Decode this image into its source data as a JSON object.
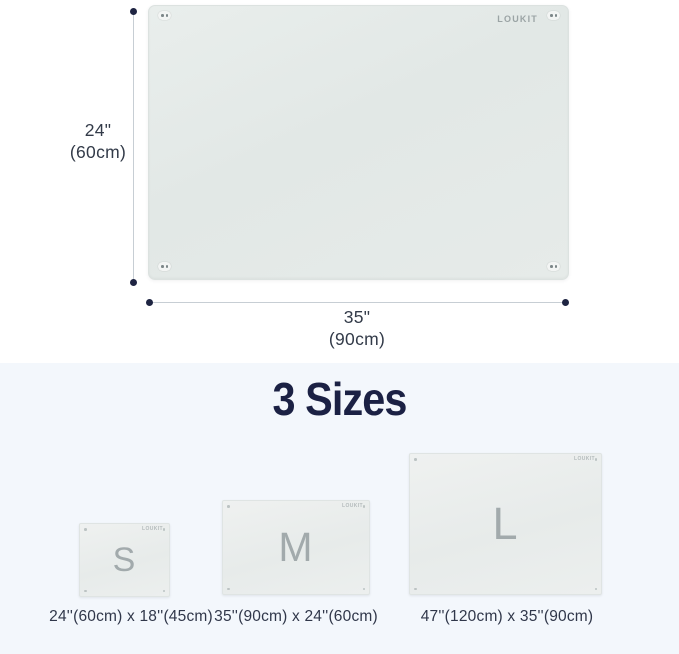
{
  "brand": "LOUKIT",
  "colors": {
    "accent_navy": "#1e2442",
    "title_navy": "#1b2144",
    "board_surface": "#e5eae8",
    "dimension_line": "#c7ced4",
    "section_background": "#f3f7fc",
    "letter_gray": "#a2aaac"
  },
  "hero": {
    "height_label": {
      "line1": "24\"",
      "line2": "(60cm)"
    },
    "width_label": {
      "line1": "35\"",
      "line2": "(90cm)"
    }
  },
  "sizes": {
    "title": "3 Sizes",
    "items": [
      {
        "letter": "S",
        "label": "24''(60cm) x 18''(45cm)"
      },
      {
        "letter": "M",
        "label": "35''(90cm) x 24''(60cm)"
      },
      {
        "letter": "L",
        "label": "47''(120cm) x 35''(90cm)"
      }
    ]
  }
}
